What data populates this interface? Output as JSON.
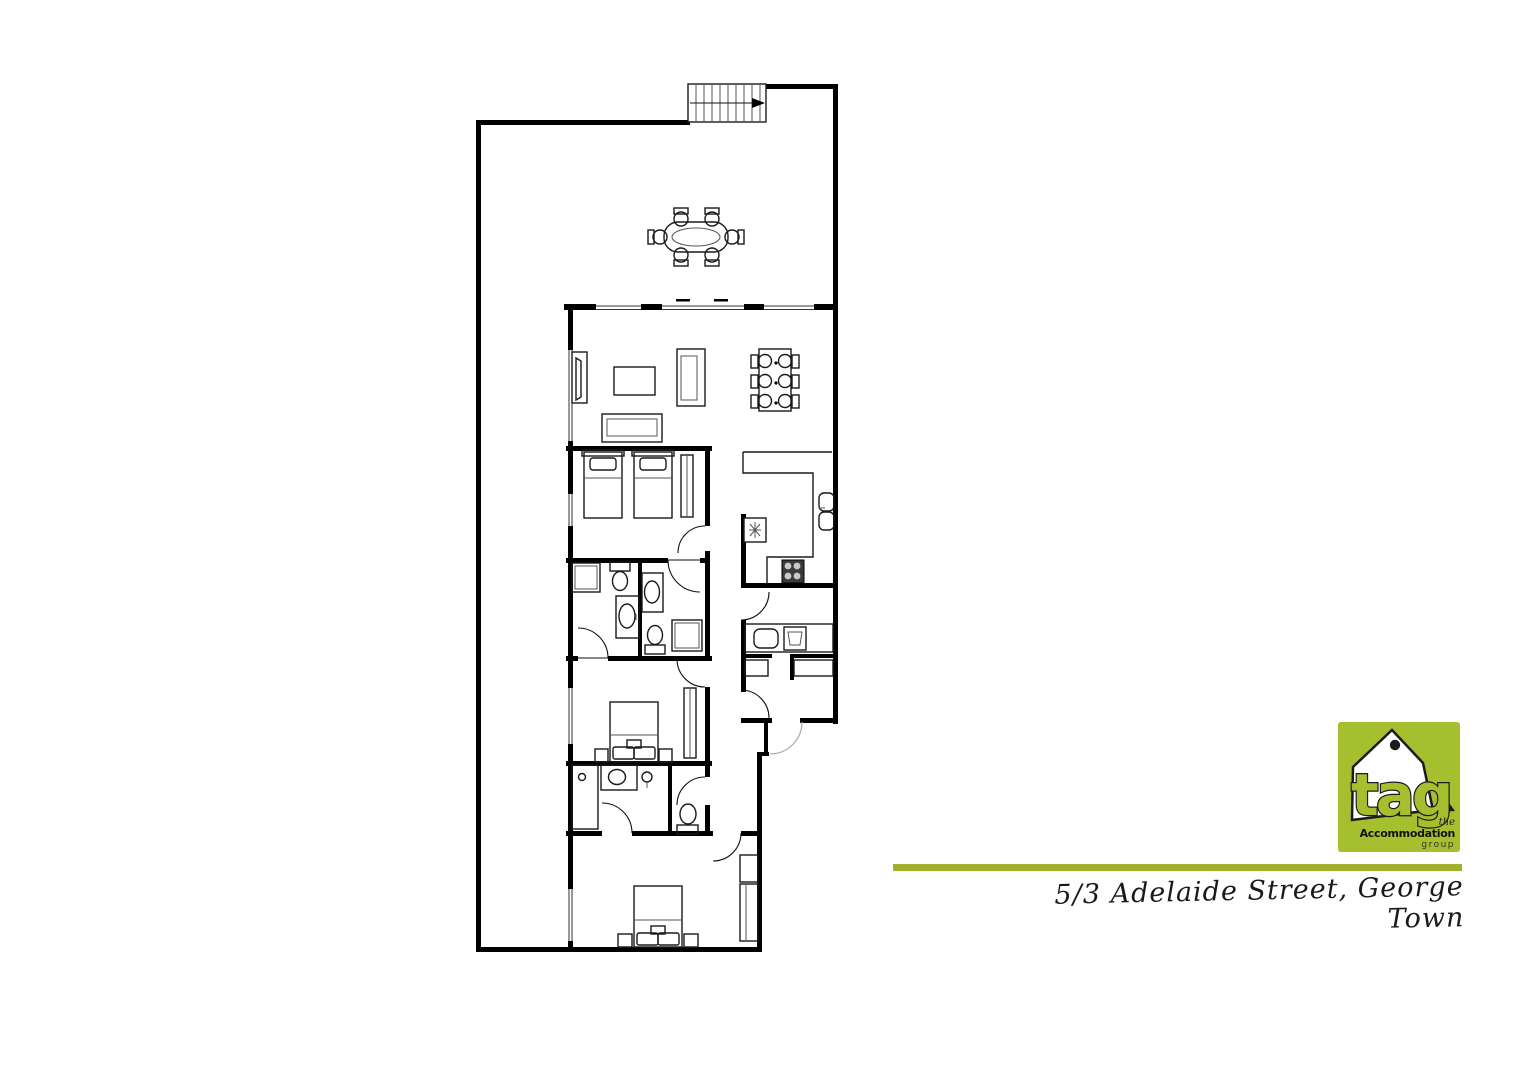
{
  "address": {
    "text": "5/3 Adelaide Street, George Town"
  },
  "branding": {
    "logo_text": "tag",
    "tagline_the": "the",
    "tagline_main": "Accommodation",
    "tagline_sub": "group",
    "logo_bg_color": "#a6bf2f",
    "logo_text_color": "#a6bf2f",
    "logo_house_color": "#ffffff",
    "logo_outline_color": "#1c1c1c",
    "divider_color": "#a2b12b"
  },
  "floorplan": {
    "wall_color": "#000000",
    "background": "#ffffff",
    "features": [
      "external-stairs-with-arrow",
      "deck-outdoor-dining-set-6-chairs",
      "living-room-tv-unit",
      "living-room-coffee-table",
      "living-room-sofa-vertical",
      "living-room-sofa-horizontal",
      "dining-table-6-chairs",
      "kitchen-bench",
      "fridge",
      "stove-4-burners",
      "double-sink",
      "laundry-bench",
      "laundry-sink",
      "washing-machine",
      "storage-shelves",
      "twin-bedroom-two-single-beds",
      "twin-bedroom-wardrobe",
      "queen-bedroom-bed-with-side-tables",
      "queen-bedroom-wardrobe",
      "rear-bedroom-bed-with-side-tables",
      "rear-bedroom-closet",
      "ensuite-1-shower-toilet-vanity",
      "ensuite-2-vanity-toilet-shower",
      "rear-bathroom-shower-vanity",
      "separate-wc-toilet",
      "door-swings",
      "windows",
      "entry-door"
    ]
  }
}
